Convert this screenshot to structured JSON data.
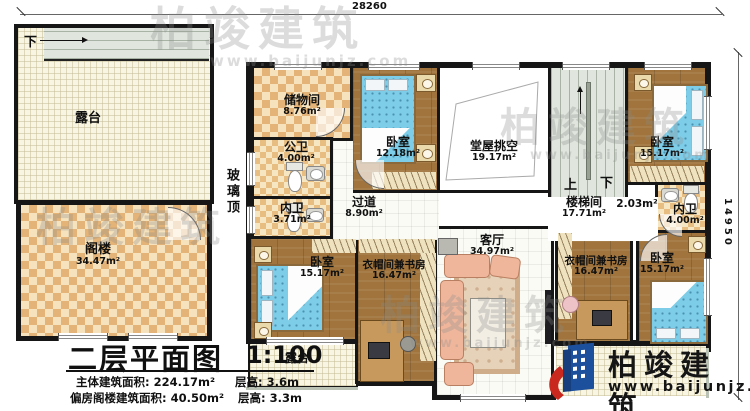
{
  "dimensions": {
    "top": "28260",
    "right": "14950"
  },
  "annex": {
    "terrace": {
      "name": "露台"
    },
    "stairs_down_label": "下",
    "attic": {
      "name": "阁楼",
      "area": "34.47m²"
    },
    "glass_roof": "玻璃顶"
  },
  "rooms": {
    "storage": {
      "name": "储物间",
      "area": "8.76m²"
    },
    "public_bath": {
      "name": "公卫",
      "area": "4.00m²"
    },
    "inner_bath_left": {
      "name": "内卫",
      "area": "3.71m²"
    },
    "bedroom_nw": {
      "name": "卧室",
      "area": "12.18m²"
    },
    "hall_void": {
      "name": "堂屋挑空",
      "area": "19.17m²"
    },
    "corridor": {
      "name": "过道",
      "area": "8.90m²"
    },
    "stairwell": {
      "name": "楼梯间",
      "area": "17.71m²",
      "landing_area": "2.03m²",
      "up_label": "上",
      "down_label": "下"
    },
    "bedroom_ne": {
      "name": "卧室",
      "area": "15.17m²"
    },
    "inner_bath_right": {
      "name": "内卫",
      "area": "4.00m²"
    },
    "bedroom_sw": {
      "name": "卧室",
      "area": "15.17m²"
    },
    "study_left": {
      "name": "衣帽间兼书房",
      "area": "16.47m²"
    },
    "living": {
      "name": "客厅",
      "area": "34.97m²"
    },
    "study_right": {
      "name": "衣帽间兼书房",
      "area": "16.47m²"
    },
    "bedroom_se": {
      "name": "卧室",
      "area": "15.17m²"
    },
    "terrace_south": {
      "name": "露台"
    }
  },
  "titleblock": {
    "title": "二层平面图",
    "scale": "1:100",
    "stats": [
      {
        "label": "主体建筑面积:",
        "value": "224.17m²",
        "height_label": "层高:",
        "height_value": "3.6m"
      },
      {
        "label": "偏房阁楼建筑面积:",
        "value": "40.50m²",
        "height_label": "层高:",
        "height_value": "3.3m"
      }
    ]
  },
  "brand": {
    "company": "柏竣建筑",
    "website": "www.baijunjz.com"
  },
  "colors": {
    "wall": "#161616",
    "wood": "#a0743c",
    "checker_dark": "#e3b377",
    "checker_light": "#f6e3bd",
    "bed": "#7ecde8",
    "logo_blue": "#1c4f9c",
    "logo_red": "#c8281e"
  }
}
